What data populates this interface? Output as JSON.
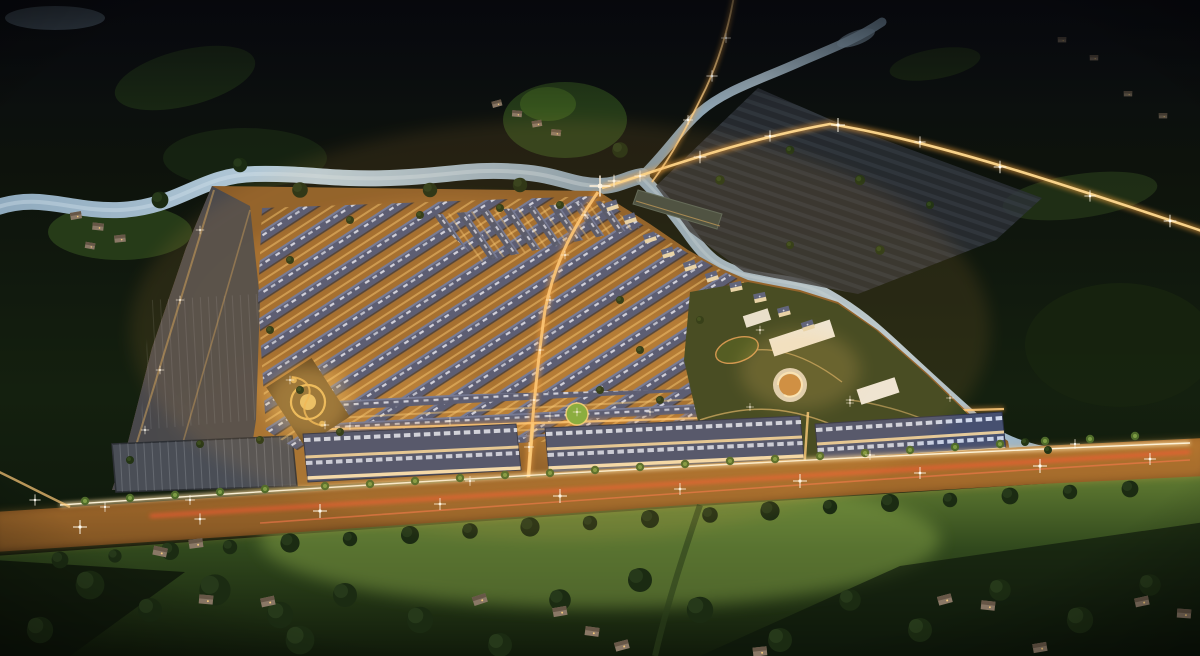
{
  "scene": {
    "description": "Aerial night-time architectural rendering of a master-planned residential township: grids of lit townhouse rows with blue-gray roofs, shophouse blocks along a bright boulevard with light trails, a golden landscaped park, a clubhouse complex with a spiral building, villas along a winding canal, a river and dark green farmland with scattered village houses surrounding the estate.",
    "type": "architectural-rendering",
    "time_of_day": "night",
    "elements": [
      "forest-hills",
      "river",
      "north-stream",
      "canal",
      "pond",
      "main-boulevard",
      "light-trails",
      "township-estate",
      "townhouse-rows",
      "shophouse-blocks",
      "parking-lot",
      "vacant-plots",
      "golden-light-park",
      "neighborhood-park",
      "amenity-gardens",
      "clubhouse-buildings",
      "spiral-building",
      "canal-villas",
      "perimeter-road",
      "access-road",
      "subdivided-plots",
      "village-houses",
      "farm-fields",
      "street-trees",
      "palm-trees",
      "street-lights"
    ]
  },
  "palette": {
    "sky_land_dark": "#0a0c10",
    "forest": "#14200f",
    "meadow": "#2b451c",
    "water": "#9db6c8",
    "water_deep": "#7d97ab",
    "estate_ground": "#8a5c28",
    "street_glow": "#f2a848",
    "roof_blue": "#4c5678",
    "roof_panel": "#dfe7fb",
    "facade_lit": "#f6d59c",
    "parking_gray": "#4a4e56",
    "plots_gray": "#2d3138",
    "white_building": "#efece2",
    "gold_park": "#f3c35e",
    "light_trail_red": "#ff5a35",
    "light_trail_white": "#ffe2a8",
    "lawn_lit": "#647f33",
    "tree_dark": "#1b2b12",
    "palm_green": "#4f6b2a",
    "glint_white": "#fff8e8"
  }
}
